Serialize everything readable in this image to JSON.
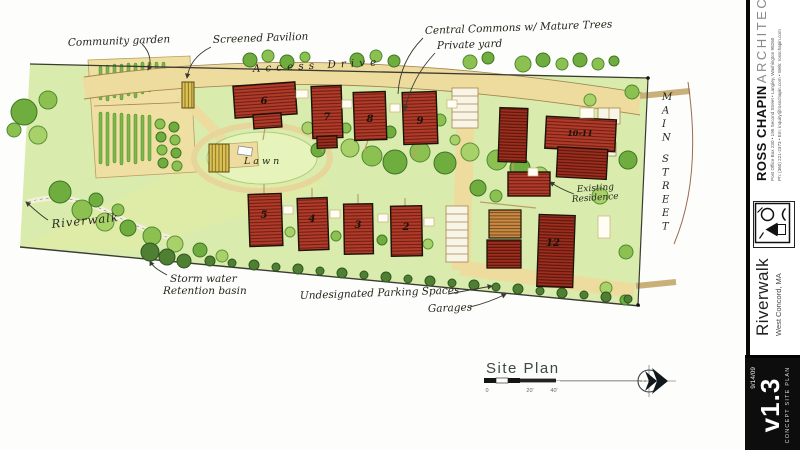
{
  "plan": {
    "labels": {
      "community_garden": "Community garden",
      "screened_pavilion": "Screened Pavilion",
      "central_commons": "Central Commons w/ Mature Trees",
      "private_yard": "Private yard",
      "access_drive": "Access Drive",
      "main_street": "MAIN STREET",
      "riverwalk_path": "Riverwalk",
      "lawn": "Lawn",
      "stormwater_line1": "Storm water",
      "stormwater_line2": "Retention basin",
      "undesignated_parking": "Undesignated Parking Spaces",
      "garages": "Garages",
      "existing_line1": "Existing",
      "existing_line2": "Residence"
    },
    "buildings": [
      "6",
      "7",
      "8",
      "9",
      "10-11",
      "12",
      "5",
      "4",
      "3",
      "2"
    ],
    "title": "Site Plan",
    "scale_ticks": [
      "0",
      "20'",
      "40'"
    ]
  },
  "sidebar": {
    "firm_name_bold": "ROSS CHAPIN",
    "firm_name_light": "ARCHITECTS",
    "address_line1": "Post Office Box 230 • 195 Second Street • Langley, Washington  98260",
    "address_line2": "Ph: (360) 221-2373 • Em: inquiry@rosschapin.com • Web: rosschapin.com",
    "project_name": "Riverwalk",
    "project_location": "West Concord, MA",
    "date": "9/14/09",
    "version": "v1.3",
    "sheet_title": "CONCEPT SITE PLAN"
  },
  "colors": {
    "roof_red": "#b23b2a",
    "drive_tan": "#eedb9e",
    "site_green": "#d9ecad",
    "ink": "#26261c"
  }
}
